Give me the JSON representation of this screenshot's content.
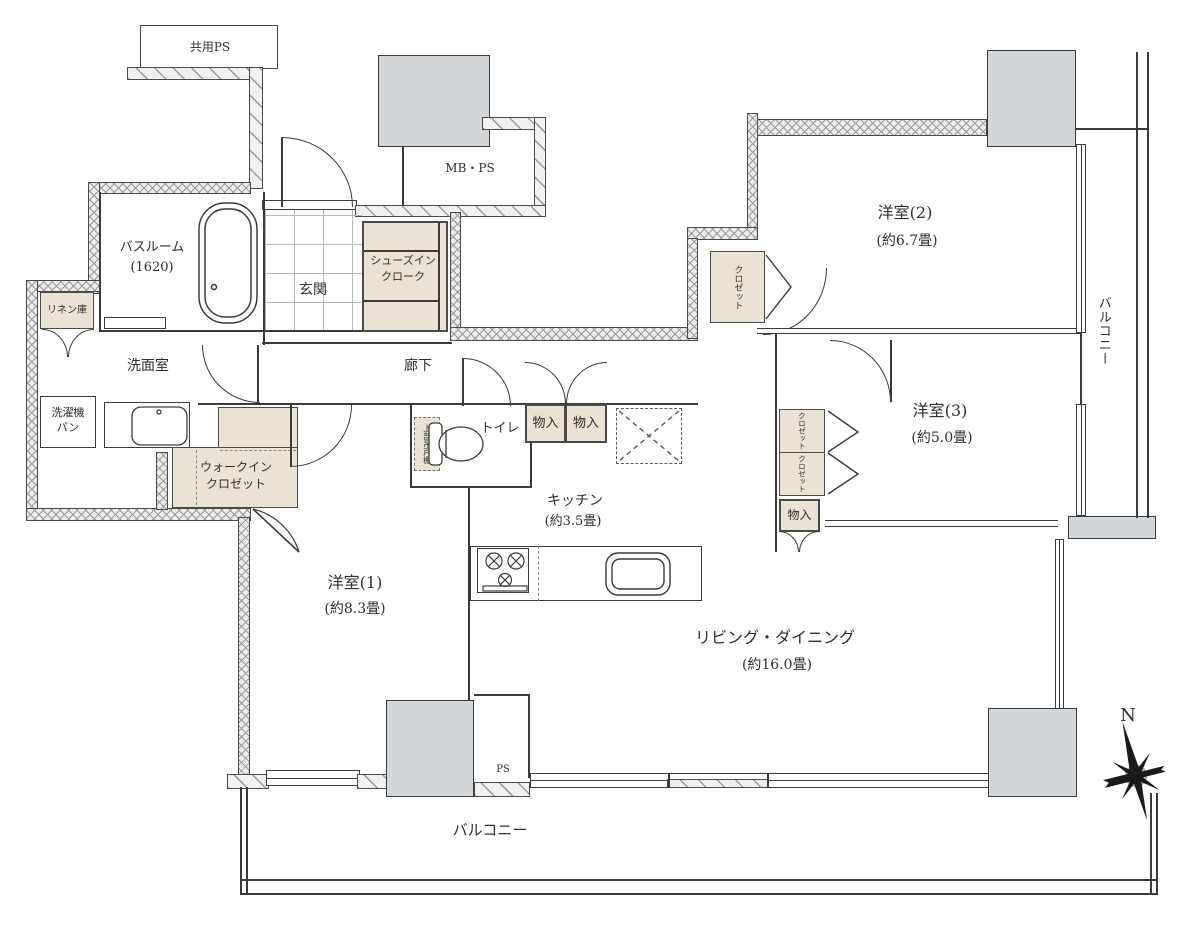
{
  "plan": {
    "common_ps": "共用PS",
    "mbps": "MB・PS",
    "bathroom": {
      "name": "バスルーム",
      "size": "(1620)"
    },
    "linen": "リネン庫",
    "washroom": "洗面室",
    "washer_line1": "洗濯機",
    "washer_line2": "パン",
    "wic_line1": "ウォークイン",
    "wic_line2": "クロゼット",
    "entrance": "玄関",
    "shoes_line1": "シューズイン",
    "shoes_line2": "クローク",
    "hallway": "廊下",
    "toilet": "トイレ",
    "upper_cabinet": "上部吊戸棚",
    "storage": "物入",
    "kitchen": {
      "name": "キッチン",
      "size": "(約3.5畳)"
    },
    "bedroom1": {
      "name": "洋室(1)",
      "size": "(約8.3畳)"
    },
    "bedroom2": {
      "name": "洋室(2)",
      "size": "(約6.7畳)"
    },
    "bedroom3": {
      "name": "洋室(3)",
      "size": "(約5.0畳)"
    },
    "closet": "クロゼット",
    "living": {
      "name": "リビング・ダイニング",
      "size": "(約16.0畳)"
    },
    "balcony": "バルコニー",
    "ps": "PS",
    "north": "N"
  },
  "colors": {
    "closet_fill": "#eae3d3",
    "pillar_fill": "#d4d7da",
    "wall_line": "#3a3a3a"
  }
}
